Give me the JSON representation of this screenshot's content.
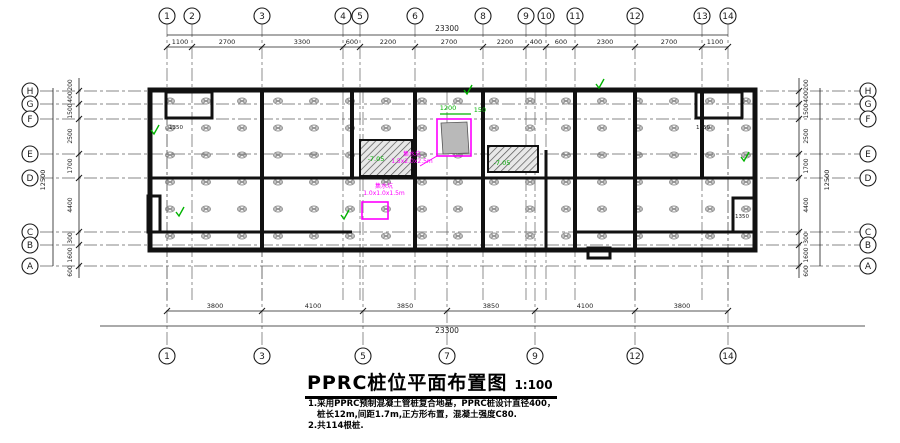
{
  "title": {
    "text": "PPRC桩位平面布置图",
    "scale": "1:100"
  },
  "notes": [
    "1.采用PPRC预制混凝土管桩复合地基，PPRC桩设计直径400，",
    "桩长12m,间距1.7m,正方形布置，混凝土强度C80.",
    "2.共114根桩."
  ],
  "colors": {
    "wall": "#111111",
    "grid_line": "#606060",
    "dim": "#1c1c1c",
    "pile": "#8f8f8f",
    "green": "#00b300",
    "magenta": "#ff00ff",
    "bg": "#ffffff"
  },
  "axes": {
    "top_bubbles": [
      {
        "label": "1",
        "x": 167
      },
      {
        "label": "2",
        "x": 192
      },
      {
        "label": "3",
        "x": 262
      },
      {
        "label": "4",
        "x": 343
      },
      {
        "label": "5",
        "x": 360
      },
      {
        "label": "6",
        "x": 415
      },
      {
        "label": "8",
        "x": 483
      },
      {
        "label": "9",
        "x": 526
      },
      {
        "label": "10",
        "x": 546
      },
      {
        "label": "11",
        "x": 575
      },
      {
        "label": "12",
        "x": 635
      },
      {
        "label": "13",
        "x": 702
      },
      {
        "label": "14",
        "x": 728
      }
    ],
    "bottom_bubbles": [
      {
        "label": "1",
        "x": 167
      },
      {
        "label": "3",
        "x": 262
      },
      {
        "label": "5",
        "x": 363
      },
      {
        "label": "7",
        "x": 447
      },
      {
        "label": "9",
        "x": 535
      },
      {
        "label": "12",
        "x": 635
      },
      {
        "label": "14",
        "x": 728
      }
    ],
    "side_bubbles": [
      {
        "label": "H",
        "y": 91
      },
      {
        "label": "G",
        "y": 104
      },
      {
        "label": "F",
        "y": 119
      },
      {
        "label": "E",
        "y": 154
      },
      {
        "label": "D",
        "y": 178
      },
      {
        "label": "C",
        "y": 232
      },
      {
        "label": "B",
        "y": 245
      },
      {
        "label": "A",
        "y": 266
      }
    ]
  },
  "dimensions": {
    "top_total": {
      "text": "23300",
      "x": 447,
      "y": 31
    },
    "top_segments": [
      {
        "text": "1100",
        "x": 180
      },
      {
        "text": "2700",
        "x": 227
      },
      {
        "text": "3300",
        "x": 302
      },
      {
        "text": "600",
        "x": 352
      },
      {
        "text": "2200",
        "x": 388
      },
      {
        "text": "2700",
        "x": 449
      },
      {
        "text": "2200",
        "x": 505
      },
      {
        "text": "400",
        "x": 536
      },
      {
        "text": "600",
        "x": 561
      },
      {
        "text": "2300",
        "x": 605
      },
      {
        "text": "2700",
        "x": 669
      },
      {
        "text": "1100",
        "x": 715
      }
    ],
    "bottom_segments": [
      {
        "text": "3800",
        "x": 215
      },
      {
        "text": "4100",
        "x": 313
      },
      {
        "text": "3850",
        "x": 405
      },
      {
        "text": "3850",
        "x": 491
      },
      {
        "text": "4100",
        "x": 585
      },
      {
        "text": "3800",
        "x": 682
      }
    ],
    "bottom_total": {
      "text": "23300",
      "x": 447,
      "y": 333
    },
    "side_segments": [
      {
        "text": "200",
        "y": 85
      },
      {
        "text": "400",
        "y": 97
      },
      {
        "text": "1500",
        "y": 111
      },
      {
        "text": "2500",
        "y": 136
      },
      {
        "text": "1700",
        "y": 166
      },
      {
        "text": "4400",
        "y": 205
      },
      {
        "text": "300",
        "y": 238
      },
      {
        "text": "1600",
        "y": 255
      },
      {
        "text": "600",
        "y": 271
      }
    ],
    "side_total": {
      "text": "12500",
      "y": 180
    },
    "inner_dims": [
      {
        "text": "1350",
        "x": 176,
        "y": 129
      },
      {
        "text": "1350",
        "x": 703,
        "y": 129
      },
      {
        "text": "1350",
        "x": 742,
        "y": 218
      }
    ]
  },
  "annotations": {
    "green_labels": [
      {
        "text": "-7.05",
        "x": 376,
        "y": 161
      },
      {
        "text": "-7.05",
        "x": 502,
        "y": 165
      },
      {
        "text": "1200",
        "x": 448,
        "y": 110
      },
      {
        "text": "150",
        "x": 480,
        "y": 112
      }
    ],
    "green_marks": [
      [
        599,
        84
      ],
      [
        154,
        130
      ],
      [
        179,
        212
      ],
      [
        467,
        90
      ],
      [
        744,
        157
      ],
      [
        344,
        215
      ]
    ],
    "magenta_labels": [
      {
        "lines": [
          "集水坑",
          "1.5x2.0x2.5m"
        ],
        "x": 412,
        "y": 156
      },
      {
        "lines": [
          "集水坑",
          "1.0x1.0x1.5m"
        ],
        "x": 384,
        "y": 188
      }
    ]
  },
  "piles": {
    "cols": [
      170,
      206,
      242,
      278,
      314,
      350,
      386,
      422,
      458,
      494,
      530,
      566,
      602,
      638,
      674,
      710,
      746
    ],
    "rows": [
      101,
      128,
      155,
      182,
      209,
      236
    ]
  }
}
